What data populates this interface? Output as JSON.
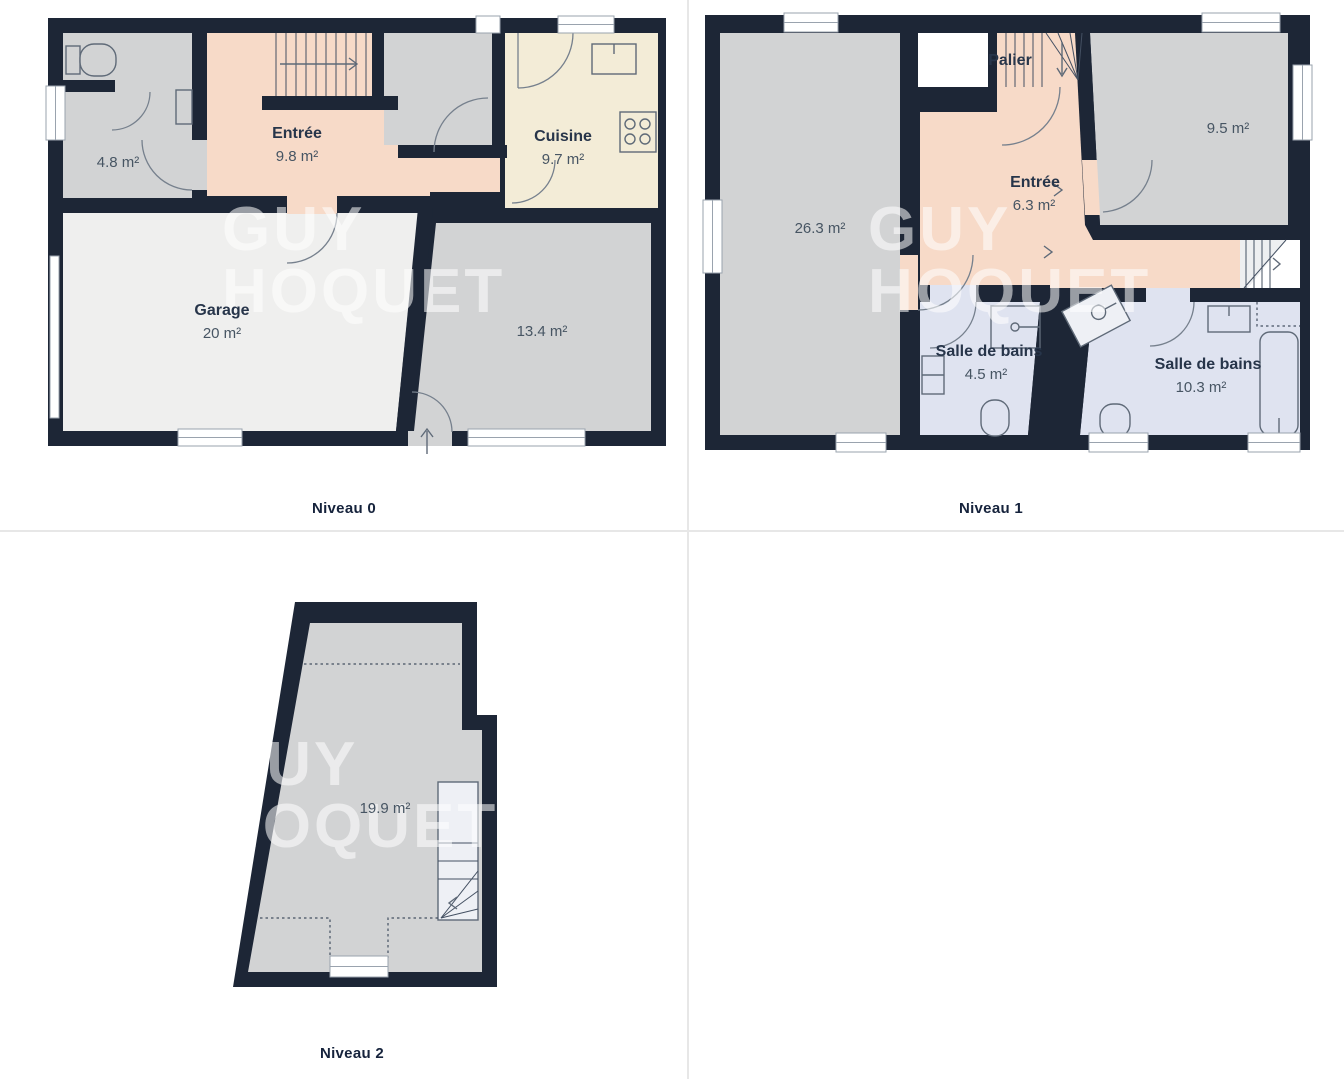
{
  "watermark": {
    "line1": "GUY",
    "line2": "HOQUET"
  },
  "panels": {
    "level0": {
      "caption": "Niveau 0",
      "rooms": {
        "wc": {
          "area": "4.8 m²"
        },
        "entree": {
          "name": "Entrée",
          "area": "9.8 m²"
        },
        "cuisine": {
          "name": "Cuisine",
          "area": "9.7 m²"
        },
        "garage": {
          "name": "Garage",
          "area": "20 m²"
        },
        "room134": {
          "area": "13.4 m²"
        }
      }
    },
    "level1": {
      "caption": "Niveau 1",
      "rooms": {
        "palier": {
          "name": "Palier"
        },
        "sejour": {
          "area": "26.3 m²"
        },
        "chambre": {
          "area": "9.5 m²"
        },
        "entree": {
          "name": "Entrée",
          "area": "6.3 m²"
        },
        "sdb1": {
          "name": "Salle de bains",
          "area": "4.5 m²"
        },
        "sdb2": {
          "name": "Salle de bains",
          "area": "10.3 m²"
        }
      }
    },
    "level2": {
      "caption": "Niveau 2",
      "rooms": {
        "attic": {
          "area": "19.9 m²"
        }
      }
    }
  },
  "colors": {
    "wall": "#1d2636",
    "grayRoom": "#d2d3d4",
    "lightRoom": "#efefee",
    "salmon": "#f7dac8",
    "cream": "#f3ecd7",
    "blue": "#dfe3f0",
    "stairLight": "#edeff1",
    "fixture": "#5f6a78",
    "labelName": "#27354a",
    "labelArea": "#475563",
    "caption": "#16233c",
    "divider": "#e7e7e7",
    "watermark": "rgba(255,255,255,0.55)"
  }
}
